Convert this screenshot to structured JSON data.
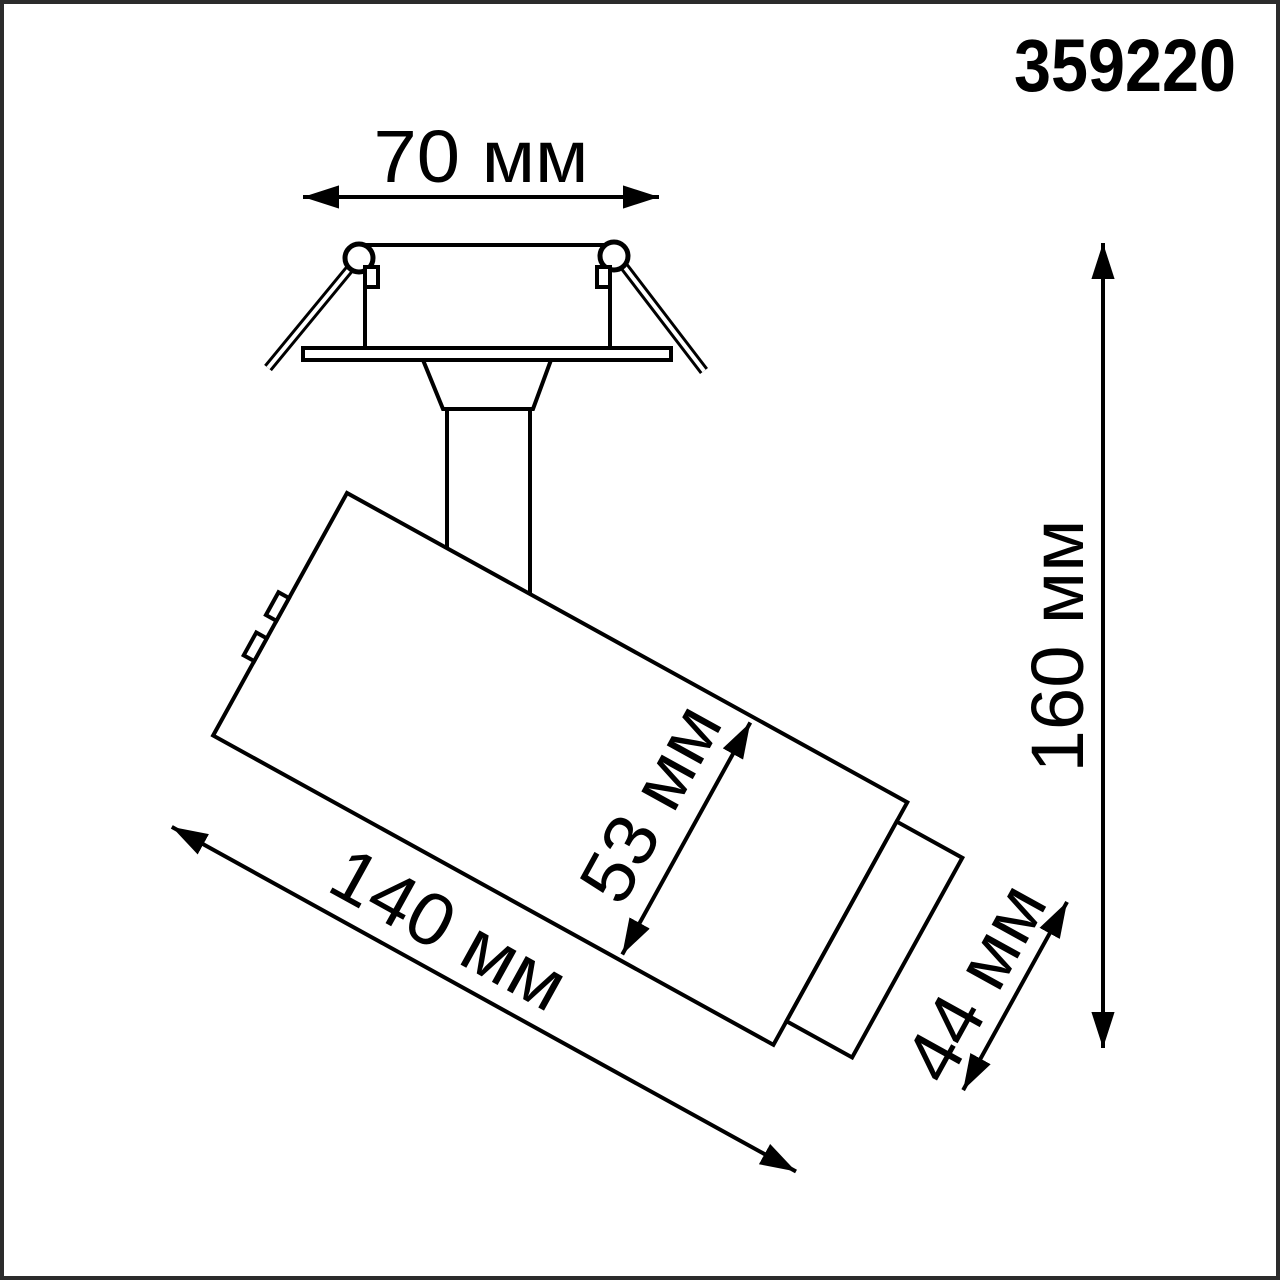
{
  "drawing": {
    "product_code": "359220",
    "dimensions": {
      "flange_width": "70 мм",
      "overall_height": "160 мм",
      "body_diameter": "53 мм",
      "head_diameter": "44 мм",
      "body_length": "140 мм"
    },
    "colors": {
      "line": "#000000",
      "background": "#ffffff",
      "border": "#2b2b2b"
    }
  }
}
